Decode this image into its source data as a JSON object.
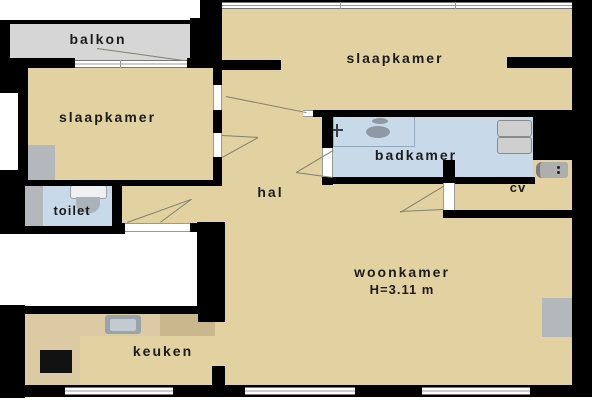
{
  "plan_title": "apartment floor plan",
  "rooms": {
    "balkon": {
      "label": "balkon"
    },
    "slaapkamer_left": {
      "label": "slaapkamer"
    },
    "slaapkamer_right": {
      "label": "slaapkamer"
    },
    "badkamer": {
      "label": "badkamer"
    },
    "toilet": {
      "label": "toilet"
    },
    "hal": {
      "label": "hal"
    },
    "cv": {
      "label": "cv"
    },
    "woonkamer": {
      "label": "woonkamer",
      "ceiling_height": "H=3.11 m"
    },
    "keuken": {
      "label": "keuken"
    }
  },
  "fixtures": [
    "shower",
    "shower-tap",
    "washer-dryer-stack",
    "cv-boiler",
    "toilet-bowl",
    "toilet-cistern",
    "wardrobe",
    "kitchen-counter",
    "kitchen-sink",
    "stove",
    "radiator"
  ],
  "colors": {
    "floor_tan": "#e2d2a2",
    "wet_room_blue": "#c8d9ea",
    "balcony_gray": "#d6d6d6",
    "wall_black": "#000000",
    "counter_light": "#dbcaa4",
    "counter_dark": "#c9b78e",
    "fixture_gray": "#b4b8bc",
    "window_line_gray": "#9a9a9a"
  }
}
